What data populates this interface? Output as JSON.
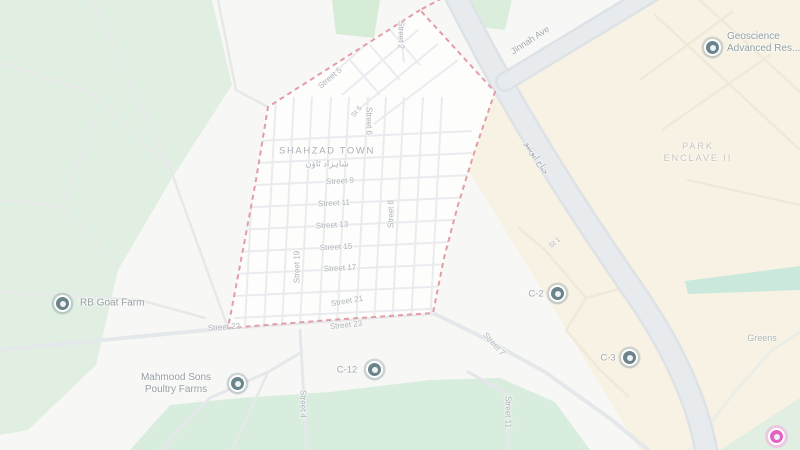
{
  "town": {
    "name": "SHAHZAD TOWN",
    "name_urdu": "شاہزاد ٹاؤن"
  },
  "areas": {
    "park_enclave_line1": "PARK",
    "park_enclave_line2": "ENCLAVE II",
    "greens": "Greens"
  },
  "roads": {
    "jinnah_ave": "Jinnah Ave",
    "jinnah_ave_urdu": "جناح ایوینیو"
  },
  "streets": [
    "Street 2",
    "Street 5",
    "St 5",
    "Street 6",
    "Street 9",
    "Street 11",
    "Street 13",
    "Street 15",
    "Street 17",
    "Street 19",
    "Street 8",
    "Street 21",
    "Street 23",
    "Street 22",
    "Street 4",
    "Street 7",
    "Street 11",
    "St 1"
  ],
  "places": {
    "geoscience_line1": "Geoscience",
    "geoscience_line2": "Advanced Res...",
    "rb_goat_farm": "RB Goat Farm",
    "mahmood_line1": "Mahmood Sons",
    "mahmood_line2": "Poultry Farms",
    "c12": "C-12",
    "c2": "C-2",
    "c3": "C-3"
  },
  "colors": {
    "boundary_pink": "#dc8591",
    "park_green": "#d9ecdb",
    "urban_beige": "#f6efdd",
    "road_gray": "#dce1e6",
    "marker_teal": "#47656f",
    "marker_pink": "#df3bb4"
  }
}
